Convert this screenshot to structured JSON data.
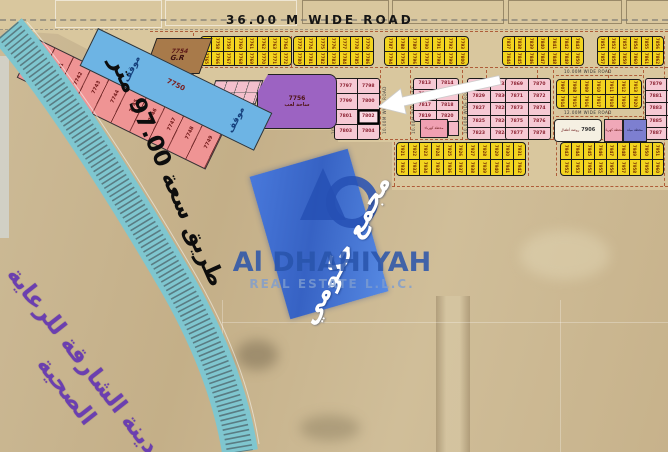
{
  "title_road": "36.00 M WIDE ROAD",
  "side_road": "طريق سعة 97.00 متر",
  "healthcare": {
    "line1": "مدينة الشارقة للرعاية",
    "line2": "الصحية"
  },
  "overlay": {
    "label": "مجمع حكومي"
  },
  "watermark": {
    "brand": "Al DHAHIYAH",
    "subtitle": "REAL ESTATE L.L.C."
  },
  "roads": {
    "w10": "10.00M WIDE ROAD",
    "w12": "12.00M WIDE ROAD"
  },
  "plots": {
    "parking": {
      "number": "7750",
      "label": "موقف"
    },
    "gr": {
      "number": "7754",
      "label": "G.R"
    },
    "playground": {
      "number": "7756",
      "label": "ساحة لعب"
    },
    "nursery": {
      "number": "7906",
      "label": "روضة أطفال"
    },
    "utility1": {
      "label": "محطة كهرباء"
    },
    "utility2": {
      "label": "محطة مياه"
    },
    "highlighted": "7802",
    "diagonal_strip": [
      "7740",
      "7741",
      "7742",
      "7743",
      "7744",
      "7745",
      "7746",
      "7747",
      "7748",
      "7749"
    ],
    "pink_blocks": {
      "b1": [
        [
          "7797",
          "7798"
        ],
        [
          "7799",
          "7800"
        ],
        [
          "7801",
          "7802"
        ],
        [
          "7803",
          "7804"
        ]
      ],
      "b2": [
        [
          "7813",
          "7814"
        ],
        [
          "7815",
          "7816"
        ],
        [
          "7817",
          "7818"
        ],
        [
          "7819",
          "7820"
        ]
      ],
      "b3": [
        [
          "7831",
          "7832"
        ],
        [
          "7829",
          "7830"
        ],
        [
          "7827",
          "7828"
        ],
        [
          "7825",
          "7826"
        ],
        [
          "7823",
          "7824"
        ]
      ],
      "b4": [
        [
          "7869",
          "7870"
        ],
        [
          "7871",
          "7872"
        ],
        [
          "7873",
          "7874"
        ],
        [
          "7875",
          "7876"
        ],
        [
          "7877",
          "7878"
        ]
      ],
      "b5": [
        [
          "7879",
          "7880"
        ],
        [
          "7881",
          "7882"
        ],
        [
          "7883",
          "7884"
        ],
        [
          "7885",
          "7886"
        ],
        [
          "7887",
          "7888"
        ]
      ]
    },
    "yellow_strips": {
      "a1": {
        "start": 7757,
        "cols": 8
      },
      "a2": {
        "start": 7773,
        "cols": 7
      },
      "a3": {
        "start": 7787,
        "cols": 7
      },
      "a4": {
        "start": 7837,
        "cols": 7
      },
      "a5": {
        "start": 7851,
        "cols": 6
      },
      "b1": {
        "start": 7921,
        "cols": 11
      },
      "b2": {
        "start": 7943,
        "cols": 9
      },
      "c1": {
        "start": 7907,
        "cols": 7
      }
    }
  },
  "colors": {
    "accent_blue": "#2b5fd2",
    "logo_blue": "#2a55aa",
    "plot_yellow": "#f2d41f",
    "plot_pink": "#f6c9d4",
    "strip_salmon": "#ef9494",
    "parking_blue": "#6db4e4",
    "purple_plot": "#9c63c2",
    "teal_road": "#7fc6cf",
    "text_purple": "#6b3fb0"
  }
}
